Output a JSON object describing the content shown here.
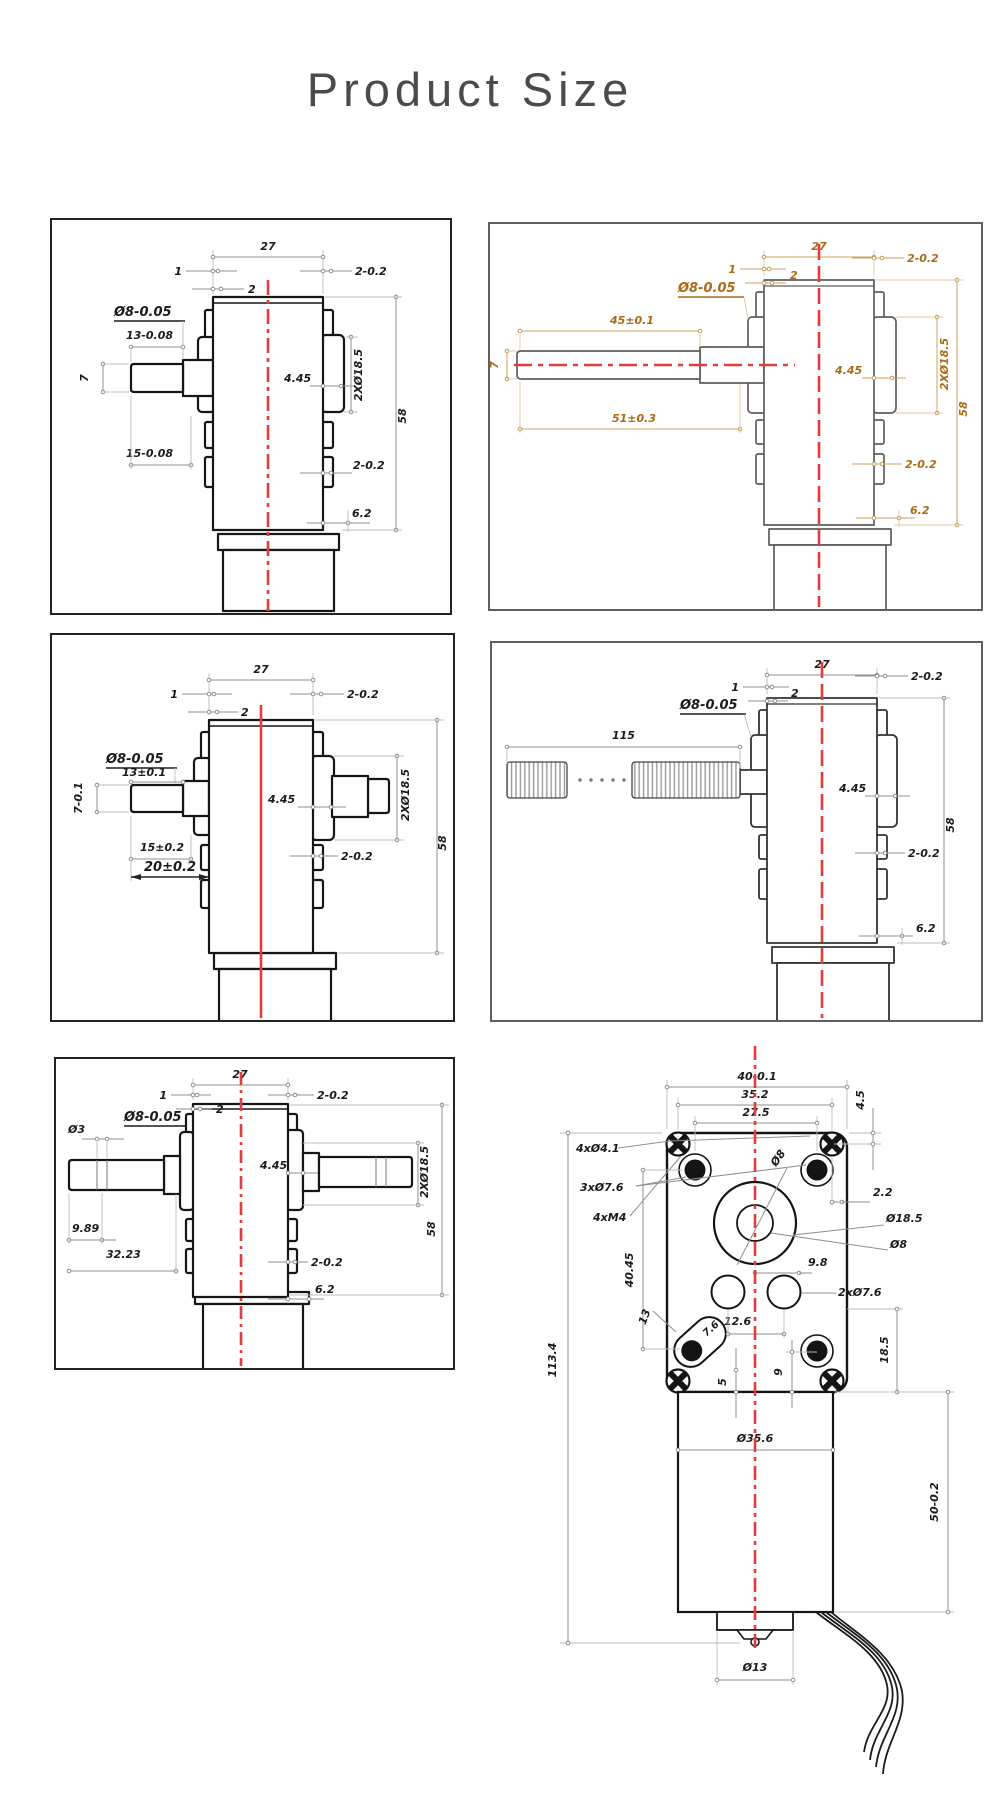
{
  "title": "Product Size",
  "colors": {
    "centerline_red": "#e23c3c",
    "dim_orange": "#ab6a15",
    "line_dark": "#161616"
  },
  "panels": {
    "top_left": {
      "dims": {
        "d27": "27",
        "d1": "1",
        "d2": "2",
        "d202a": "2-0.2",
        "dia8": "Ø8-0.05",
        "d13": "13-0.08",
        "d7": "7",
        "d15": "15-0.08",
        "d445": "4.45",
        "d2x185": "2XØ18.5",
        "d58": "58",
        "d202b": "2-0.2",
        "d62": "6.2"
      }
    },
    "top_right": {
      "dims": {
        "d27": "27",
        "d1": "1",
        "d2": "2",
        "d202a": "2-0.2",
        "dia8": "Ø8-0.05",
        "d45": "45±0.1",
        "d7": "7",
        "d51": "51±0.3",
        "d445": "4.45",
        "d2x185": "2XØ18.5",
        "d58": "58",
        "d202b": "2-0.2",
        "d62": "6.2"
      }
    },
    "mid_left": {
      "dims": {
        "d27": "27",
        "d1": "1",
        "d2": "2",
        "d202a": "2-0.2",
        "dia8": "Ø8-0.05",
        "d13": "13±0.1",
        "d7": "7-0.1",
        "d15": "15±0.2",
        "d20": "20±0.2",
        "d445": "4.45",
        "d2x185": "2XØ18.5",
        "d58": "58",
        "d202b": "2-0.2"
      }
    },
    "mid_right": {
      "dims": {
        "d27": "27",
        "d1": "1",
        "d2": "2",
        "d202a": "2-0.2",
        "dia8": "Ø8-0.05",
        "d115": "115",
        "d445": "4.45",
        "d58": "58",
        "d202b": "2-0.2",
        "d62": "6.2"
      }
    },
    "bottom_left": {
      "dims": {
        "d27": "27",
        "d1": "1",
        "d2": "2",
        "d202a": "2-0.2",
        "dia8": "Ø8-0.05",
        "dia3": "Ø3",
        "d445": "4.45",
        "d2x185": "2XØ18.5",
        "d58": "58",
        "d989": "9.89",
        "d3223": "32.23",
        "d202b": "2-0.2",
        "d62": "6.2"
      }
    },
    "bottom_right": {
      "dims": {
        "d40": "40-0.1",
        "d352": "35.2",
        "d275": "27.5",
        "d45": "4.5",
        "d4x41": "4xØ4.1",
        "d3x76": "3xØ7.6",
        "d4xm4": "4xM4",
        "d22": "2.2",
        "dia185": "Ø18.5",
        "dia8": "Ø8",
        "dia8b": "Ø8",
        "d4045": "40.45",
        "d98": "9.8",
        "d2x76": "2xØ7.6",
        "d13": "13",
        "d126": "12.6",
        "d76": "7.6",
        "d5": "5",
        "d9": "9",
        "d185": "18.5",
        "d1134": "113.4",
        "dia356": "Ø35.6",
        "d50": "50-0.2",
        "dia13": "Ø13"
      }
    }
  }
}
